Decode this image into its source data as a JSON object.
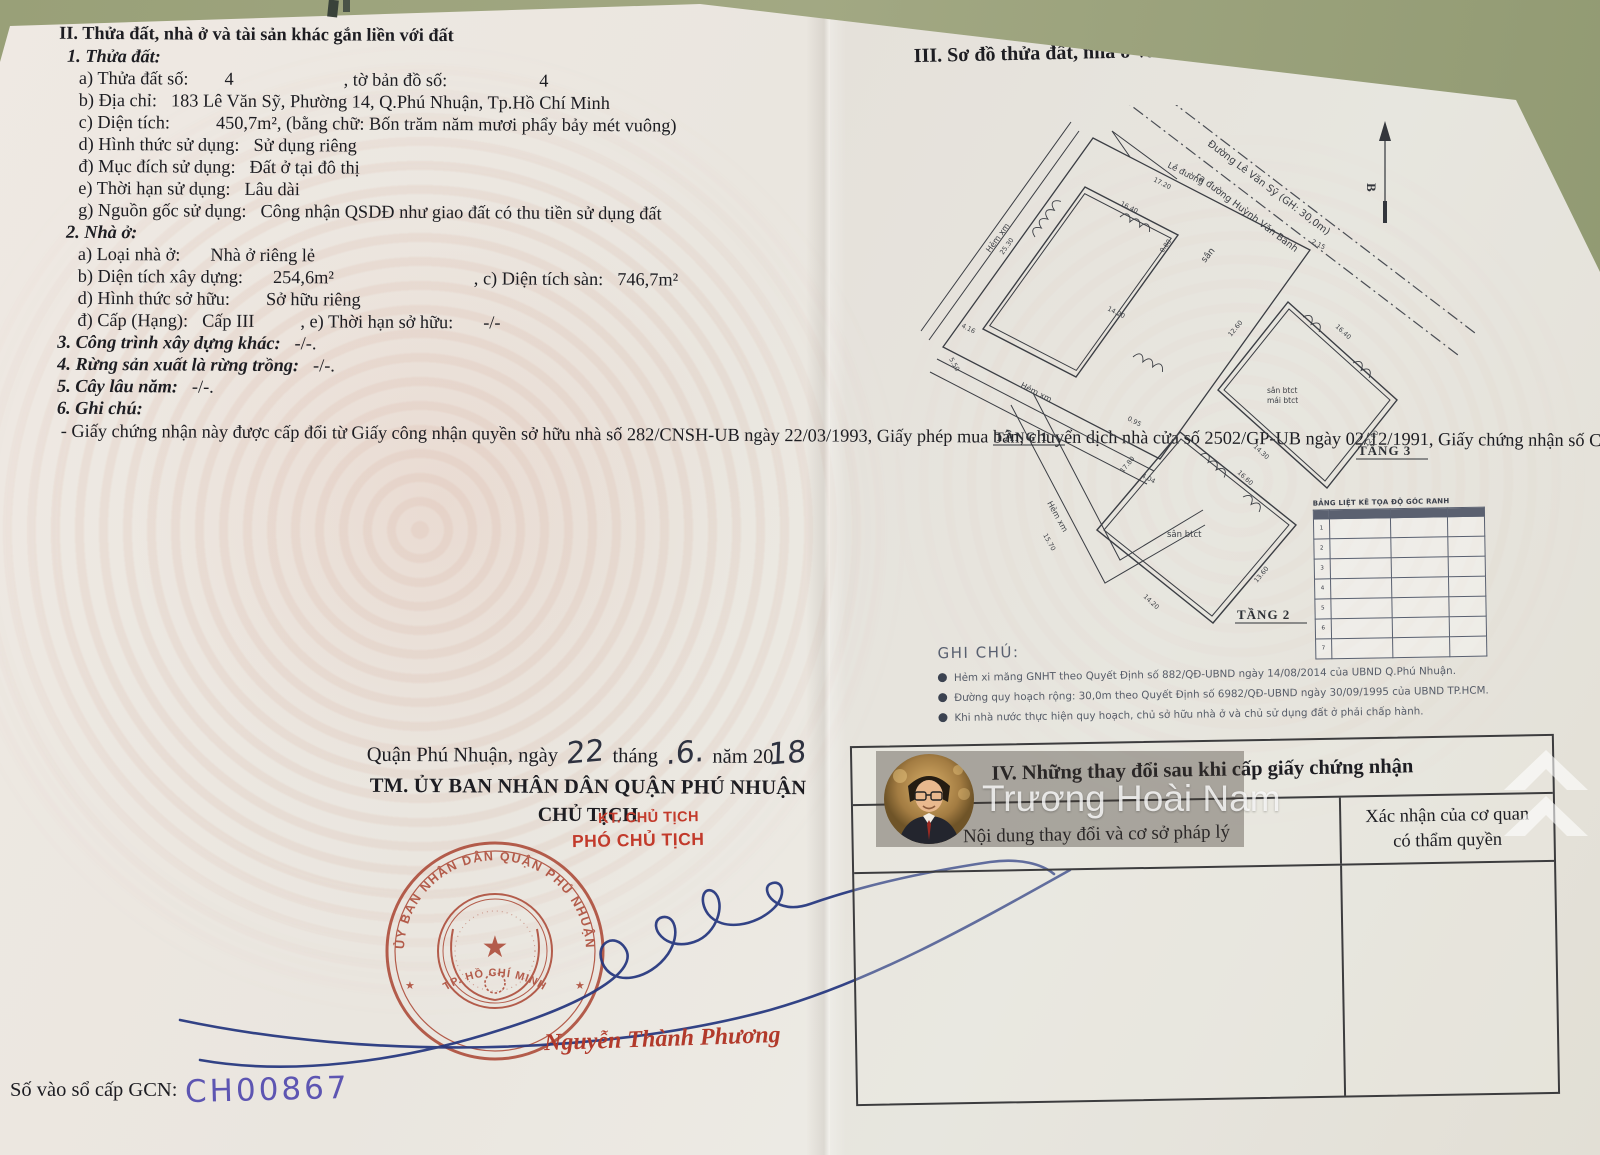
{
  "doc": {
    "left": {
      "title": "II. Thửa đất, nhà ở và tài sản khác gắn liền với đất",
      "s1_heading": "1. Thửa đất:",
      "s1": [
        {
          "label": "a) Thửa đất số:",
          "value": "4",
          "label2": ", tờ bản đồ số:",
          "value2": "4"
        },
        {
          "label": "b) Địa chỉ:",
          "value": "183 Lê Văn Sỹ, Phường 14, Q.Phú Nhuận, Tp.Hồ Chí Minh"
        },
        {
          "label": "c) Diện tích:",
          "value": "450,7m², (bằng chữ: Bốn trăm năm mươi phẩy bảy mét vuông)"
        },
        {
          "label": "d) Hình thức sử dụng:",
          "value": "Sử dụng riêng"
        },
        {
          "label": "đ) Mục đích sử dụng:",
          "value": "Đất ở tại đô thị"
        },
        {
          "label": "e) Thời hạn sử dụng:",
          "value": "Lâu dài"
        },
        {
          "label": "g) Nguồn gốc sử dụng:",
          "value": "Công nhận QSDĐ như giao đất có thu tiền sử dụng đất"
        }
      ],
      "s2_heading": "2. Nhà ở:",
      "s2": [
        {
          "label": "a) Loại nhà ở:",
          "value": "Nhà ở riêng lẻ"
        },
        {
          "label": "b) Diện tích xây dựng:",
          "value": "254,6m²",
          "label2": ", c) Diện tích sàn:",
          "value2": "746,7m²"
        },
        {
          "label": "d) Hình thức sở hữu:",
          "value": "Sở hữu riêng"
        },
        {
          "label": "đ) Cấp (Hạng):",
          "value": "Cấp III",
          "label2": ", e) Thời hạn sở hữu:",
          "value2": "-/-"
        }
      ],
      "s3": {
        "label": "3. Công trình xây dựng khác:",
        "value": "-/-."
      },
      "s4": {
        "label": "4. Rừng sản xuất là rừng trồng:",
        "value": "-/-."
      },
      "s5": {
        "label": "5. Cây lâu năm:",
        "value": "-/-."
      },
      "s6_heading": "6. Ghi chú:",
      "note": "- Giấy chứng nhận này được cấp đổi từ Giấy công nhận quyền sở hữu nhà số 282/CNSH-UB ngày 22/03/1993, Giấy phép mua bán, chuyển dịch nhà cửa số 2502/GP-UB ngày 02/12/1991, Giấy chứng nhận số CH00068 ngày 06/01/2011, số CH03290 ngày 17/12/2010 và số H.00225/61-CP/2006 ngày 26/01/2006 của UBND quận Phú Nhuận và Giấy chứng nhận số 13938/2001 ngày 17/07/2001 của UBND TPHCM."
    },
    "signing": {
      "date_prefix": "Quận Phú Nhuận, ngày",
      "day": "22",
      "thang": "tháng",
      "month": ".6.",
      "nam": "năm 20",
      "year": "18",
      "committee": "TM. ỦY BAN NHÂN DÂN QUẬN PHÚ NHUẬN",
      "chairman": "CHỦ TỊCH",
      "kt": "KT. CHỦ TỊCH",
      "deputy": "PHÓ CHỦ TỊCH",
      "signer": "Nguyễn Thành Phương",
      "seal_top": "ỦY BAN NHÂN DÂN QUẬN PHÚ NHUẬN",
      "seal_bottom": "TP. HỒ CHÍ MINH"
    },
    "registry": {
      "label": "Số vào sổ cấp GCN:",
      "value": "CH00867"
    },
    "right": {
      "title": "III. Sơ đồ thửa đất, nhà ở và tài sản khác gắn liền với đất",
      "diagram": {
        "road1": "Đường Lê Văn Sỹ (GH: 30,0m)",
        "road2": "ra đường Huỳnh Văn Bánh",
        "north_label": "B",
        "le_duong": "Lề đường",
        "hem": "Hẻm xm",
        "san": "sân",
        "san_btct": "sân btct",
        "mai_btct": "mái btct",
        "floors": [
          "TẦNG 1",
          "TẦNG 2",
          "TẦNG 3"
        ],
        "dims": [
          "17.20",
          "25.30",
          "16.40",
          "14.20",
          "0.95",
          "15.70",
          "4.16",
          "5.50",
          "2.15",
          "17.80",
          "16.60",
          "14.30",
          "13.60",
          "14.20",
          "12.60",
          "12.50",
          "16.40",
          "4.04",
          "0.80"
        ],
        "coord_table": {
          "title": "BẢNG LIỆT KÊ TỌA ĐỘ GÓC RANH",
          "row_numbers": [
            "1",
            "2",
            "3",
            "4",
            "5",
            "6",
            "7"
          ]
        }
      },
      "ghichu": {
        "title": "GHI CHÚ:",
        "notes": [
          "Hẻm xi măng GNHT theo Quyết Định số 882/QĐ-UBND ngày 14/08/2014 của UBND Q.Phú Nhuận.",
          "Đường quy hoạch rộng: 30,0m theo Quyết Định số 6982/QĐ-UBND ngày 30/09/1995 của UBND TP.HCM.",
          "Khi nhà nước thực hiện quy hoạch, chủ sở hữu nhà ở và chủ sử dụng đất ở phải chấp hành."
        ]
      },
      "section4": {
        "title": "IV. Những thay đổi sau khi cấp giấy chứng nhận",
        "col1": "Nội dung thay đổi và cơ sở pháp lý",
        "col2": "Xác nhận của cơ quan có thẩm quyền"
      }
    },
    "watermark": {
      "name": "Trương Hoài Nam"
    }
  }
}
